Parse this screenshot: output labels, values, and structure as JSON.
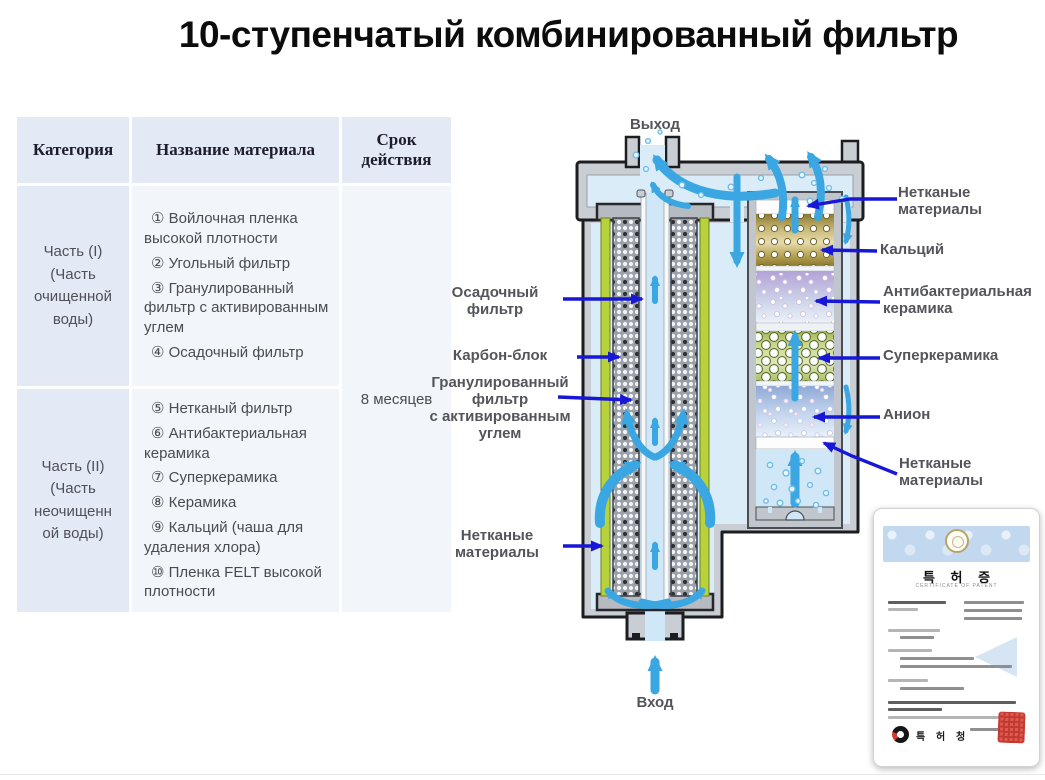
{
  "title": "10-ступенчатый комбинированный фильтр",
  "table": {
    "headers": [
      "Категория",
      "Название материала",
      "Срок действия"
    ],
    "rows": [
      {
        "category": "Часть (I)\n(Часть\nочищенной\nводы)",
        "materials": [
          "① Войлочная пленка высокой плотности",
          "② Угольный фильтр",
          "③ Гранулированный фильтр с активированным углем",
          "④ Осадочный фильтр"
        ]
      },
      {
        "category": "Часть (II)\n(Часть\nнеочищенн\nой воды)",
        "materials": [
          "⑤ Нетканый фильтр",
          "⑥ Антибактериальная керамика",
          "⑦ Суперкерамика",
          "⑧ Керамика",
          "⑨ Кальций (чаша для удаления хлора)",
          "⑩ Пленка FELT высокой плотности"
        ]
      }
    ],
    "validity": "8 месяцев"
  },
  "diagram": {
    "outlet_label": "Выход",
    "inlet_label": "Вход",
    "left_labels": [
      "Осадочный\nфильтр",
      "Карбон-блок",
      "Гранулированный\nфильтр\nс активированным\nуглем",
      "Нетканые\nматериалы"
    ],
    "right_labels": [
      "Нетканые\nматериалы",
      "Кальций",
      "Антибактериальная\nкерамика",
      "Суперкерамика",
      "Анион",
      "Нетканые\nматериалы"
    ]
  },
  "certificate": {
    "title": "특 허 증",
    "subtitle": "CERTIFICATE OF PATENT",
    "office": "특 허 청"
  },
  "colors": {
    "pointer_arrow": "#1717d6",
    "flow_arrow": "#3aa6e2",
    "table_header_bg": "#e3e9f5",
    "table_cat_bg": "#e4e9f6",
    "table_cell_bg": "#f2f5fa"
  }
}
